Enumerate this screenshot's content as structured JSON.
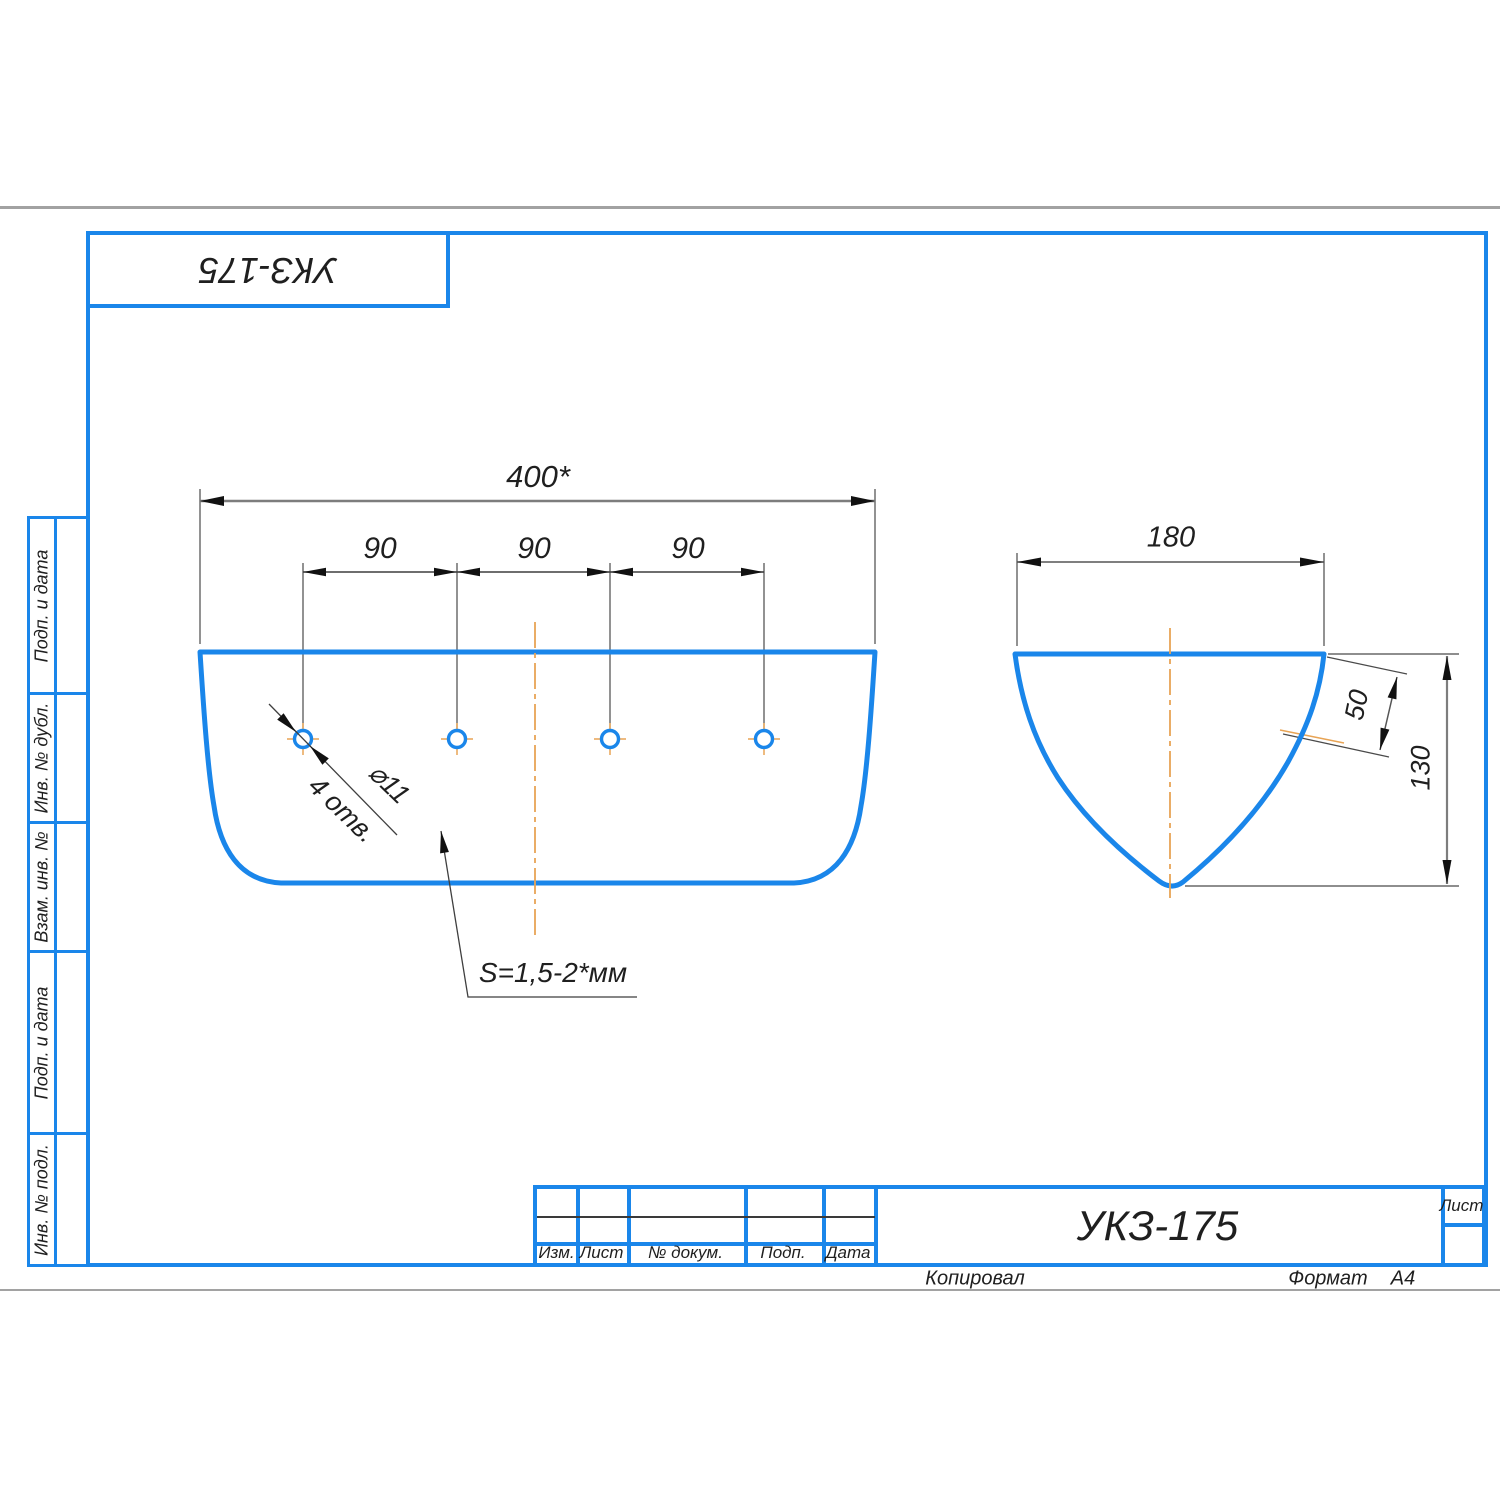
{
  "colors": {
    "outline_blue": "#1a86ea",
    "centerline_orange": "#e8a455",
    "dimension_gray": "#7d7d7d",
    "line_dark": "#3f3f3f",
    "rule_gray": "#a2a2a2"
  },
  "stamp_top": {
    "label": "УКЗ-175"
  },
  "sidebar": {
    "items": [
      {
        "label": "Подп. и дата"
      },
      {
        "label": "Инв. № дубл."
      },
      {
        "label": "Взам. инв. №"
      },
      {
        "label": "Подп. и дата"
      },
      {
        "label": "Инв. № подл."
      }
    ]
  },
  "title_block": {
    "columns": [
      "Изм.",
      "Лист",
      "№ докум.",
      "Подп.",
      "Дата"
    ],
    "doc_number": "УКЗ-175",
    "sheet_label": "Лист",
    "footer": {
      "copied": "Копировал",
      "format_label": "Формат",
      "format_value": "А4"
    }
  },
  "drawing": {
    "front_view": {
      "dim_width": "400*",
      "dim_spacing_1": "90",
      "dim_spacing_2": "90",
      "dim_spacing_3": "90",
      "hole_diameter": "⌀11",
      "hole_count": "4 отв.",
      "thickness_note": "S=1,5-2*мм"
    },
    "side_view": {
      "dim_width": "180",
      "dim_flange": "50",
      "dim_depth": "130"
    }
  }
}
